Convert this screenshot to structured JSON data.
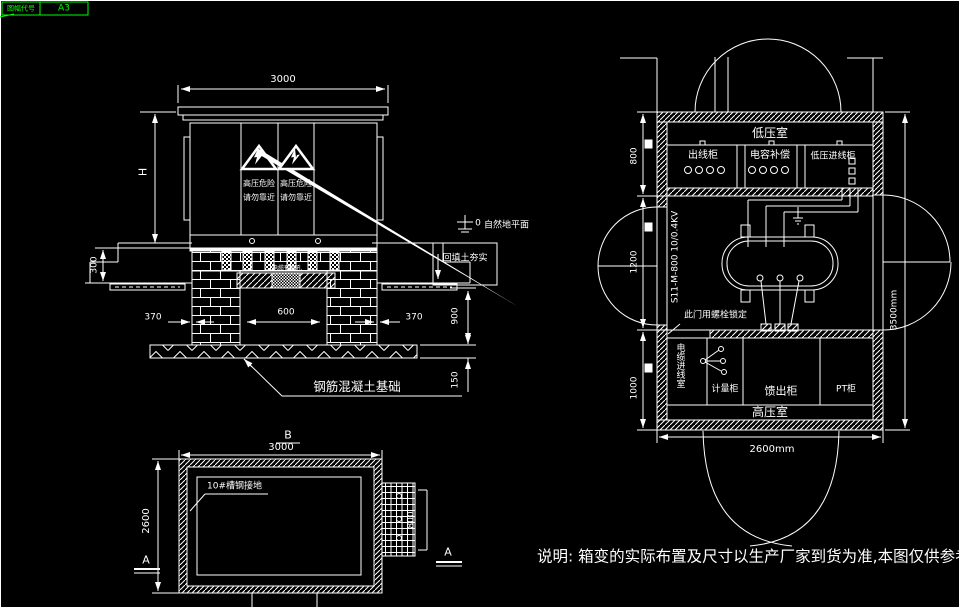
{
  "title_block": {
    "label": "图幅代号",
    "code": "A3"
  },
  "elevation": {
    "dim_width": "3000",
    "dim_height_label": "H",
    "dim_base": "300",
    "dim_pier_left": "370",
    "dim_pier_right": "370",
    "dim_opening": "600",
    "dim_depth": "900",
    "dim_slab": "150",
    "warning_line1": "高压危险",
    "warning_line2": "请勿靠近",
    "datum_value": "0",
    "datum_label": "自然地平面",
    "backfill_label": "回填土夯实",
    "beam_label": "电缆预留孔",
    "foundation_label": "钢筋混凝土基础"
  },
  "plan_section": {
    "axis_label": "B",
    "dim_width": "3000",
    "dim_depth": "2600",
    "dim_duct": "800",
    "ground_label": "10#槽钢接地",
    "section_mark_left": "A",
    "section_mark_right": "A"
  },
  "plan_layout": {
    "lv_room_label": "低压室",
    "hv_room_label": "高压室",
    "cabinet_outgoing": "出线柜",
    "cabinet_capacitor": "电容补偿",
    "cabinet_lv_incoming": "低压进线柜",
    "transformer_model": "S11-M-800 10/0.4KV",
    "door_note": "此门用螺栓锁定",
    "cable_room_label": "电缆进线室",
    "cabinet_metering": "计量柜",
    "cabinet_feeder": "馈出柜",
    "cabinet_pt": "PT柜",
    "dim_lv": "800",
    "dim_transformer": "1200",
    "dim_hv": "1000",
    "dim_depth_total": "3500mm",
    "dim_width_total": "2600mm"
  },
  "note_text": "说明: 箱变的实际布置及尺寸以生产厂家到货为准,本图仅供参考.",
  "colors": {
    "background": "#000000",
    "line": "#ffffff",
    "accent_green": "#00ff00"
  }
}
